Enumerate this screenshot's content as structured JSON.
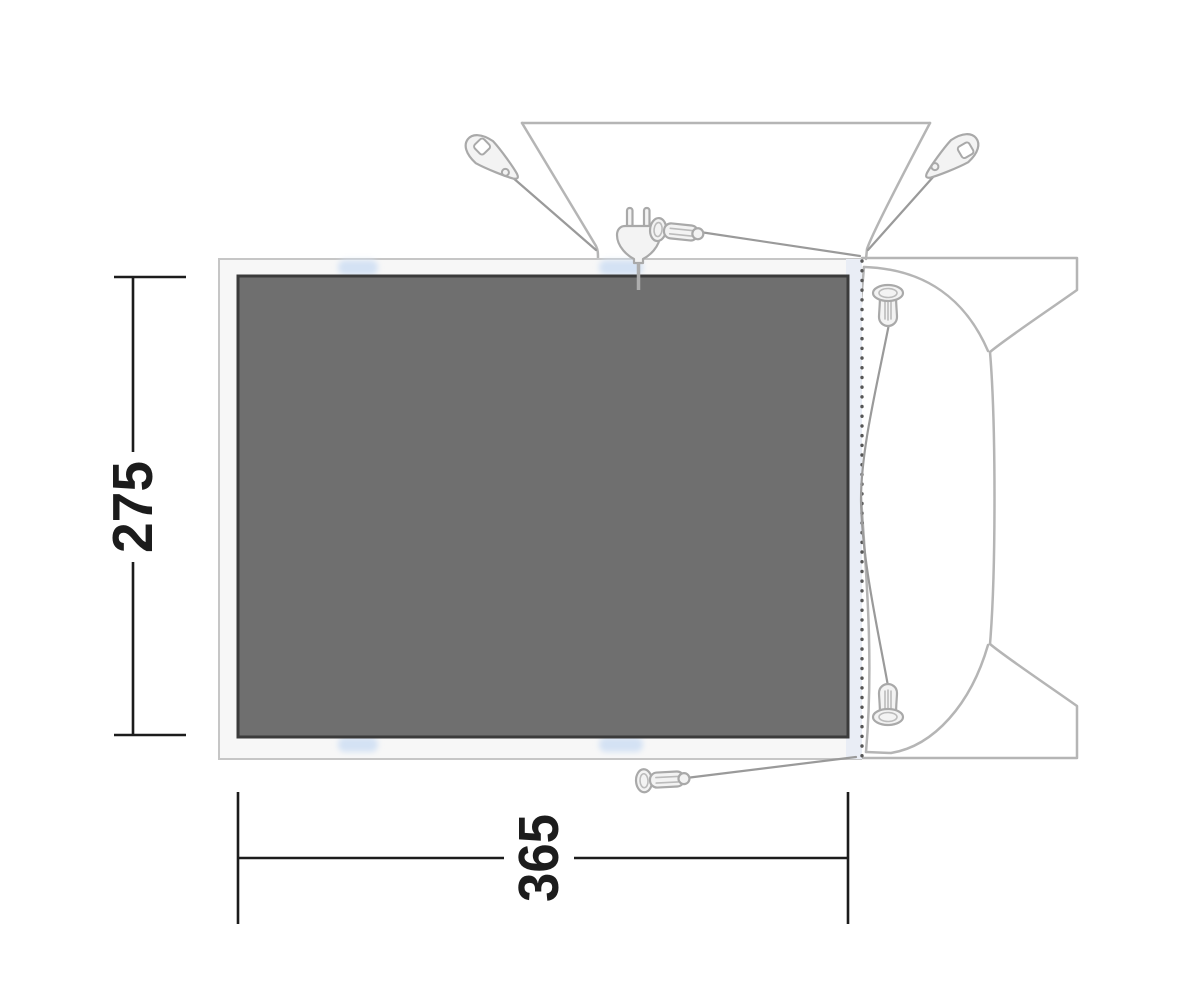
{
  "dimensions": {
    "height_cm": "275",
    "width_cm": "365"
  },
  "colors": {
    "floor_fill": "#6F6F6F",
    "floor_border": "#3B3B3B",
    "groundsheet_fill": "#F7F7F7",
    "groundsheet_border": "#C6C6C6",
    "vehicle_outline": "#B5B5B5",
    "attachment_band": "#E9EDF5",
    "attachment_tab": "#D4E2F4",
    "guyline": "#9A9A9A",
    "dimension": "#1C1C1C"
  },
  "icons": {
    "tensioner_left": "guyline-tensioner-icon",
    "tensioner_right": "guyline-tensioner-icon",
    "power_plug": "power-plug-icon",
    "peg_top": "tent-peg-icon",
    "peg_bottom": "tent-peg-icon",
    "peg_vehicle_top": "tent-peg-icon",
    "peg_vehicle_bottom": "tent-peg-icon"
  }
}
